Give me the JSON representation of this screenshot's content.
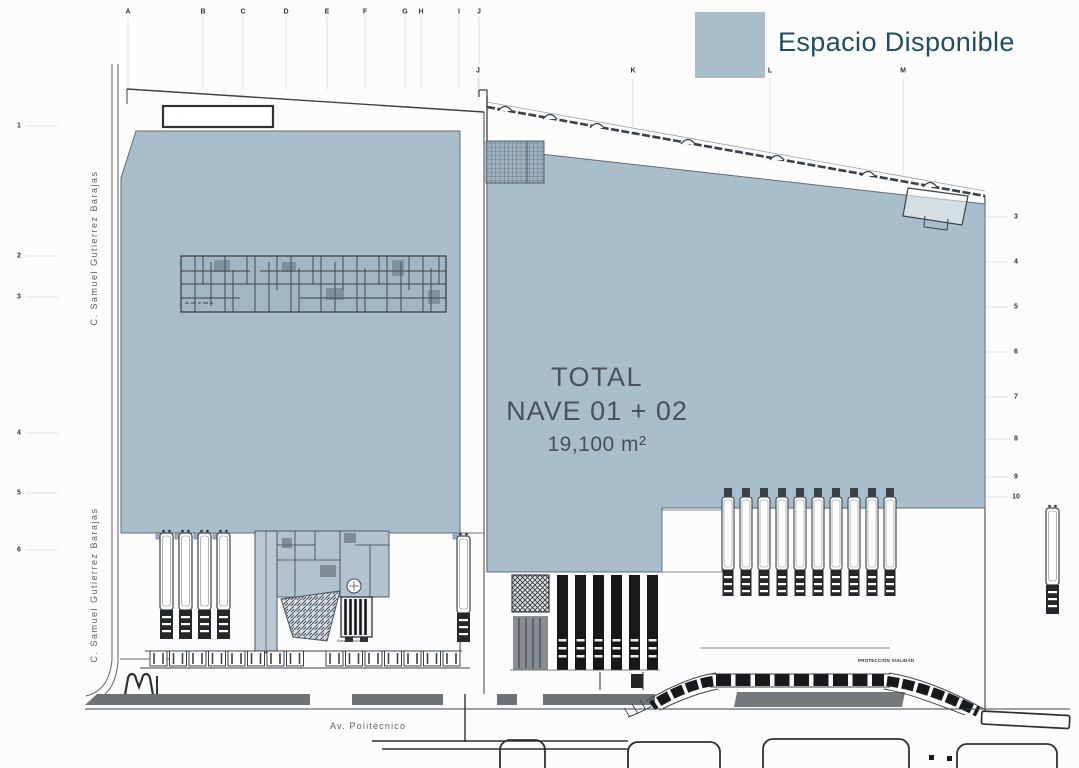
{
  "legend": {
    "label": "Espacio Disponible",
    "swatch_color": "#a9bdca",
    "label_color": "#1f4e5f"
  },
  "plan": {
    "total_title": "TOTAL",
    "total_subtitle": "NAVE 01 + 02",
    "total_area": "19,100 m²"
  },
  "streets": {
    "left_upper": "C. Samuel Gutierrez Barajas",
    "left_lower": "C. Samuel Gutierrez Barajas",
    "bottom": "Av. Politécnico"
  },
  "annotations": {
    "service_area": "Área Servicios",
    "road_protection": "PROTECCIÓN VIALIDAD"
  },
  "grid": {
    "top_letters": [
      "A",
      "B",
      "C",
      "D",
      "E",
      "F",
      "G",
      "H",
      "I",
      "J"
    ],
    "mid_letters": [
      "J",
      "K",
      "L",
      "M"
    ],
    "left_numbers": [
      "1",
      "2",
      "3",
      "4",
      "5",
      "6"
    ],
    "right_numbers": [
      "3",
      "4",
      "5",
      "6",
      "7",
      "8",
      "9",
      "10"
    ]
  },
  "colors": {
    "available_fill": "#a9bdca",
    "line": "#3b424a",
    "dock_dark": "#17191c",
    "sidewalk_gray": "#6e7276"
  }
}
